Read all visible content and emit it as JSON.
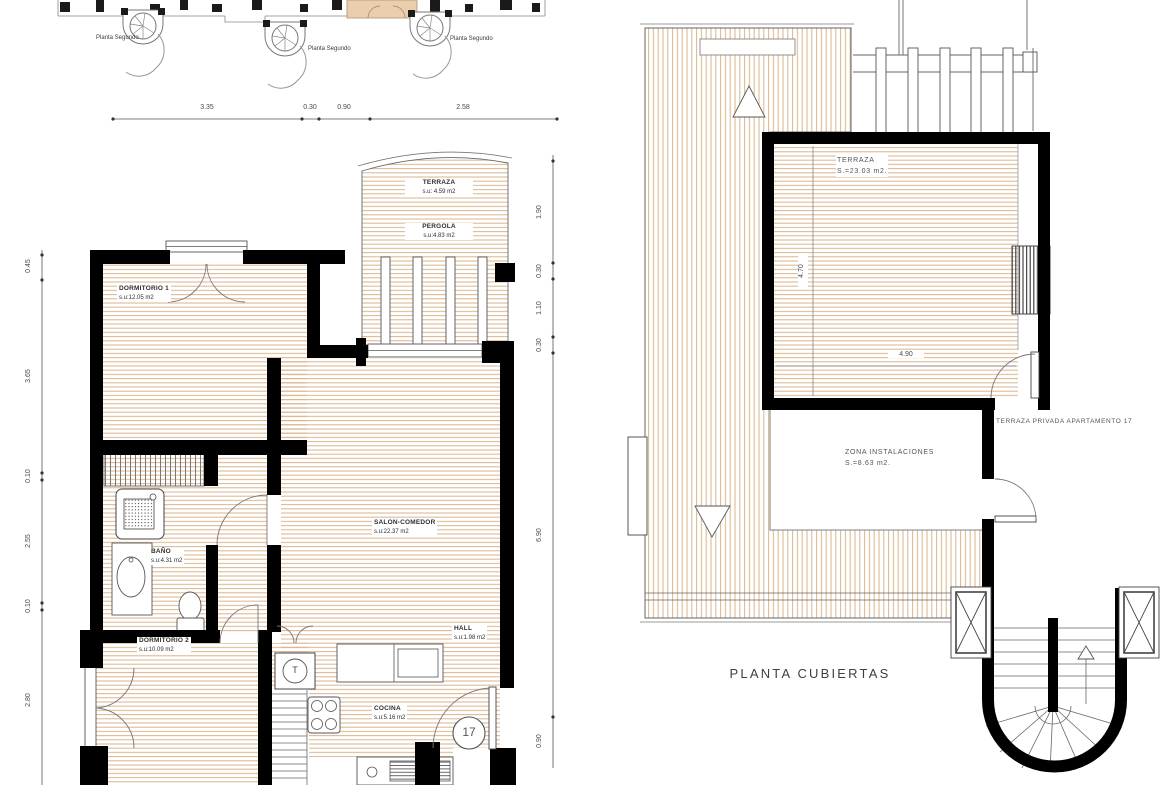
{
  "key_plan": {
    "floor_labels": [
      "Planta Segundo",
      "Planta Segundo",
      "Planta Segundo"
    ]
  },
  "apartment_plan": {
    "apartment_number": "17",
    "lift_symbol": "T",
    "rooms": {
      "terraza": {
        "name": "TERRAZA",
        "area": "s.u: 4.59 m2"
      },
      "pergola": {
        "name": "PERGOLA",
        "area": "s.u:4.83 m2"
      },
      "dormitorio1": {
        "name": "DORMITORIO 1",
        "area": "s.u:12.05 m2"
      },
      "salon_comedor": {
        "name": "SALON-COMEDOR",
        "area": "s.u:22.37 m2"
      },
      "bano": {
        "name": "BAÑO",
        "area": "s.u:4.31 m2"
      },
      "dormitorio2": {
        "name": "DORMITORIO 2",
        "area": "s.u:10.09 m2"
      },
      "hall": {
        "name": "HALL",
        "area": "s.u:1.98 m2"
      },
      "cocina": {
        "name": "COCINA",
        "area": "s.u:5.16 m2"
      }
    },
    "dims_top": [
      "3.35",
      "0.30",
      "0.90",
      "2.58"
    ],
    "dims_left": [
      "0.45",
      "3.65",
      "0.10",
      "2.55",
      "0.10",
      "2.80"
    ],
    "dims_right": [
      "1.90",
      "0.30",
      "1.10",
      "0.30",
      "6.90",
      "0.90"
    ]
  },
  "roof_plan": {
    "title": "PLANTA CUBIERTAS",
    "terraza": {
      "name": "TERRAZA",
      "area": "S.=23.03  m2."
    },
    "zona_instalaciones": {
      "name": "ZONA  INSTALACIONES",
      "area": "S.=8.63  m2."
    },
    "note": "TERRAZA  PRIVADA  APARTAMENTO  17",
    "dim_width": "4.90",
    "dim_height": "4.70"
  },
  "colors": {
    "hatch": "#d9b48c",
    "wall": "#000000",
    "highlight": "#e9cfad",
    "line": "#555555",
    "text": "#3d3d3d"
  }
}
